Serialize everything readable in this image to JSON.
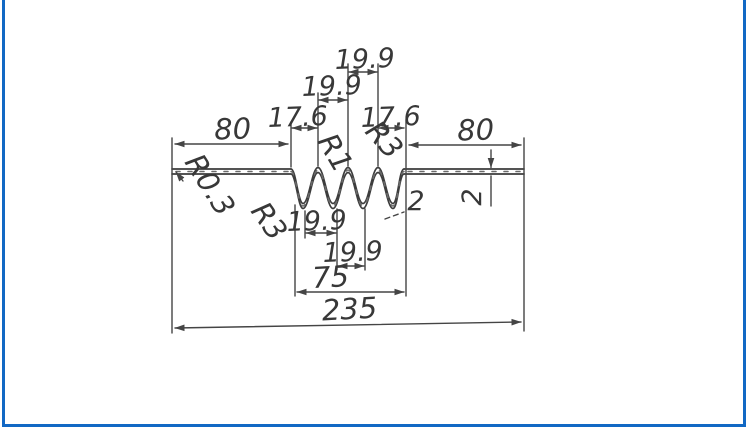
{
  "frame": {
    "border_color": "#1268c4",
    "paper_color": "#ffffff"
  },
  "drawing": {
    "ink_color": "#3d3d3d",
    "dims": {
      "left_flange_width": "80",
      "right_flange_width": "80",
      "top_pitch_left": "17.6",
      "top_pitch_mid": "19.9",
      "top_pitch_top": "19.9",
      "top_pitch_right": "17.6",
      "bottom_pitch_1": "19.9",
      "bottom_pitch_2": "19.9",
      "corrugation_span": "75",
      "overall_width": "235",
      "wave_thickness": "2",
      "flange_thickness": "2"
    },
    "radii": {
      "flange_edge_radius": "R0.3",
      "left_valley_radius": "R3",
      "crest_radius": "R1",
      "right_crest_radius": "R3"
    }
  }
}
